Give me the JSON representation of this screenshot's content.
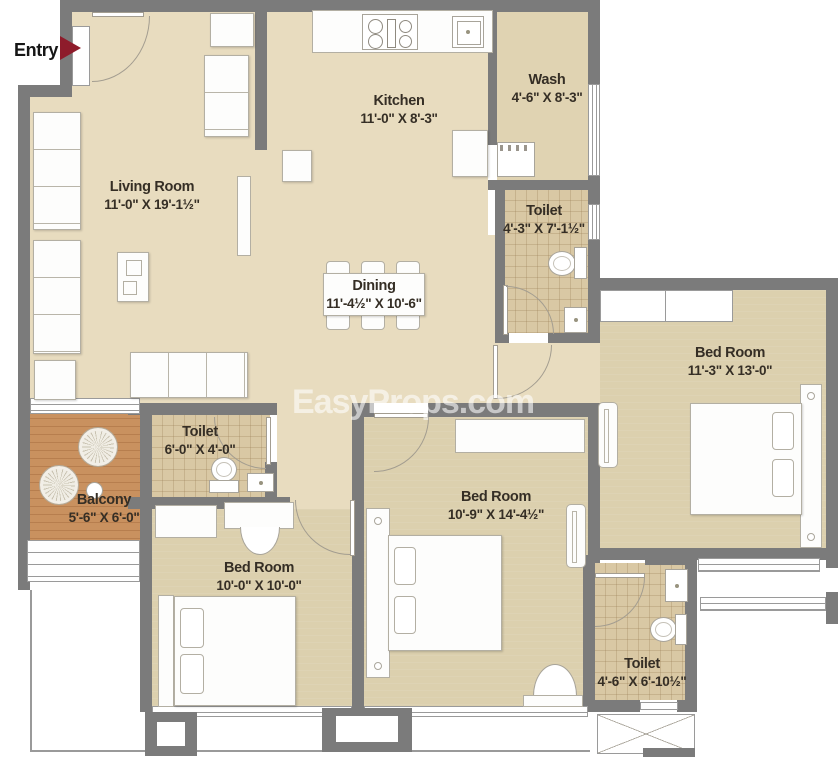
{
  "watermark": {
    "text": "EasyProps.com"
  },
  "entry": {
    "label": "Entry"
  },
  "rooms": [
    {
      "id": "living-room",
      "name": "Living Room",
      "dims": "11'-0\" X 19'-1½\""
    },
    {
      "id": "kitchen",
      "name": "Kitchen",
      "dims": "11'-0\" X 8'-3\""
    },
    {
      "id": "wash",
      "name": "Wash",
      "dims": "4'-6\" X 8'-3\""
    },
    {
      "id": "toilet-top",
      "name": "Toilet",
      "dims": "4'-3\" X 7'-1½\""
    },
    {
      "id": "bedroom-right",
      "name": "Bed Room",
      "dims": "11'-3\" X 13'-0\""
    },
    {
      "id": "dining",
      "name": "Dining",
      "dims": "11'-4½\" X 10'-6\""
    },
    {
      "id": "toilet-middle",
      "name": "Toilet",
      "dims": "6'-0\" X 4'-0\""
    },
    {
      "id": "balcony",
      "name": "Balcony",
      "dims": "5'-6\" X 6'-0\""
    },
    {
      "id": "bedroom-center",
      "name": "Bed Room",
      "dims": "10'-9\" X 14'-4½\""
    },
    {
      "id": "bedroom-left",
      "name": "Bed Room",
      "dims": "10'-0\" X 10'-0\""
    },
    {
      "id": "toilet-bottom",
      "name": "Toilet",
      "dims": "4'-6\" X 6'-10½\""
    }
  ],
  "colors": {
    "wall": "#7b7b7b",
    "floor_main": "#e8dcbf",
    "floor_bedroom": "#dcd0ae",
    "floor_toilet": "#d9c8a4",
    "floor_balcony": "#c9915f",
    "entry_arrow": "#8e1c2b"
  }
}
